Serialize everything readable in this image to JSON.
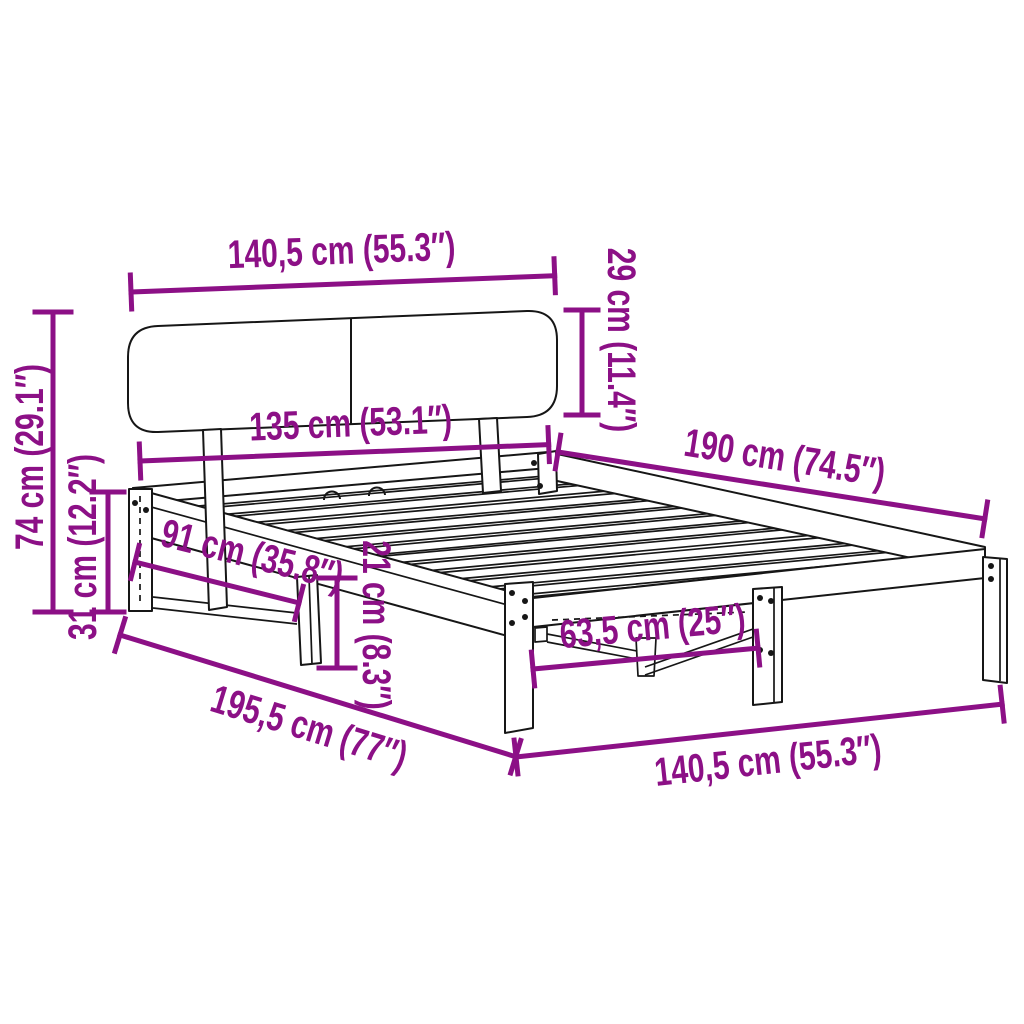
{
  "page": {
    "background": "#ffffff",
    "diagram_type": "product dimension diagram",
    "subject": "wooden bed frame with headboard and slatted base"
  },
  "colors": {
    "dimension_annotation": "#8C1086",
    "line_art": "#161616"
  },
  "units": {
    "primary": "cm",
    "secondary": "inches"
  },
  "dimensions": {
    "headboard_width": {
      "label": "140,5 cm (55.3″)",
      "cm": "140,5",
      "inches": "55.3"
    },
    "headboard_height": {
      "label": "29 cm (11.4″)",
      "cm": "29",
      "inches": "11.4"
    },
    "frame_width": {
      "label": "135 cm (53.1″)",
      "cm": "135",
      "inches": "53.1"
    },
    "frame_length": {
      "label": "190 cm (74.5″)",
      "cm": "190",
      "inches": "74.5"
    },
    "total_height": {
      "label": "74 cm (29.1″)",
      "cm": "74",
      "inches": "29.1"
    },
    "base_height": {
      "label": "31 cm (12.2″)",
      "cm": "31",
      "inches": "12.2"
    },
    "leg_span_side": {
      "label": "91 cm (35.8″)",
      "cm": "91",
      "inches": "35.8"
    },
    "clearance_height": {
      "label": "21 cm (8.3″)",
      "cm": "21",
      "inches": "8.3"
    },
    "leg_span_foot": {
      "label": "63,5 cm (25″)",
      "cm": "63,5",
      "inches": "25"
    },
    "total_length": {
      "label": "195,5 cm (77″)",
      "cm": "195,5",
      "inches": "77"
    },
    "foot_width": {
      "label": "140,5 cm (55.3″)",
      "cm": "140,5",
      "inches": "55.3"
    }
  }
}
